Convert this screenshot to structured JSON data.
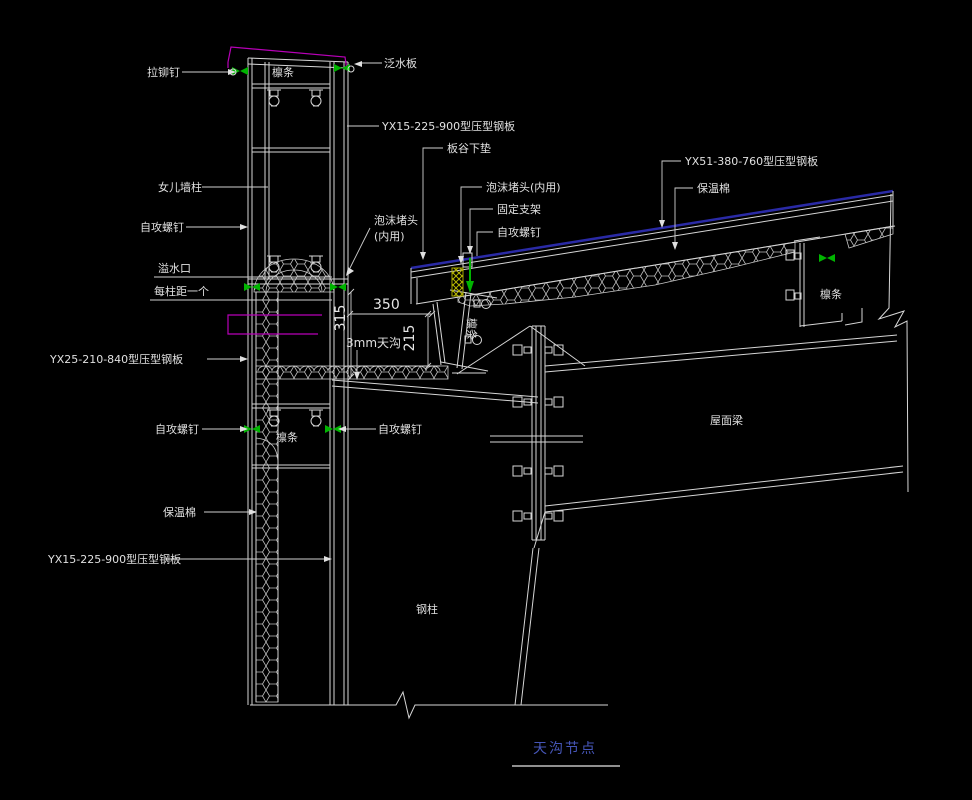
{
  "drawing": {
    "title": "天沟节点",
    "labels": {
      "rivet": "拉铆钉",
      "purlin": "檩条",
      "flashing": "泛水板",
      "yx15_panel": "YX15-225-900型压型钢板",
      "valley_pad": "板谷下垫",
      "foam_plug_l1": "泡沫堵头",
      "foam_plug_l2": "(内用)",
      "foam_plug_full": "泡沫堵头(内用)",
      "fixed_bracket": "固定支架",
      "screw": "自攻螺钉",
      "parapet_column": "女儿墙柱",
      "overflow_port": "溢水口",
      "one_per_column": "每柱距一个",
      "yx25_panel": "YX25-210-840型压型钢板",
      "insulation": "保温棉",
      "yx51_panel": "YX51-380-760型压型钢板",
      "roof_beam": "屋面梁",
      "steel_column": "钢柱"
    },
    "dimensions": {
      "gutter_width": "350",
      "gutter_depth_left": "315",
      "gutter_depth_right": "215",
      "gutter_thickness": "3mm天沟"
    },
    "colors": {
      "background": "#000000",
      "line": "#d6d6d6",
      "accent_magenta": "#b800b8",
      "accent_green": "#00b400",
      "foam_yellow": "#a8a800",
      "roof_edge_blue": "#2a2aa6",
      "title_blue": "#4656b8"
    }
  }
}
